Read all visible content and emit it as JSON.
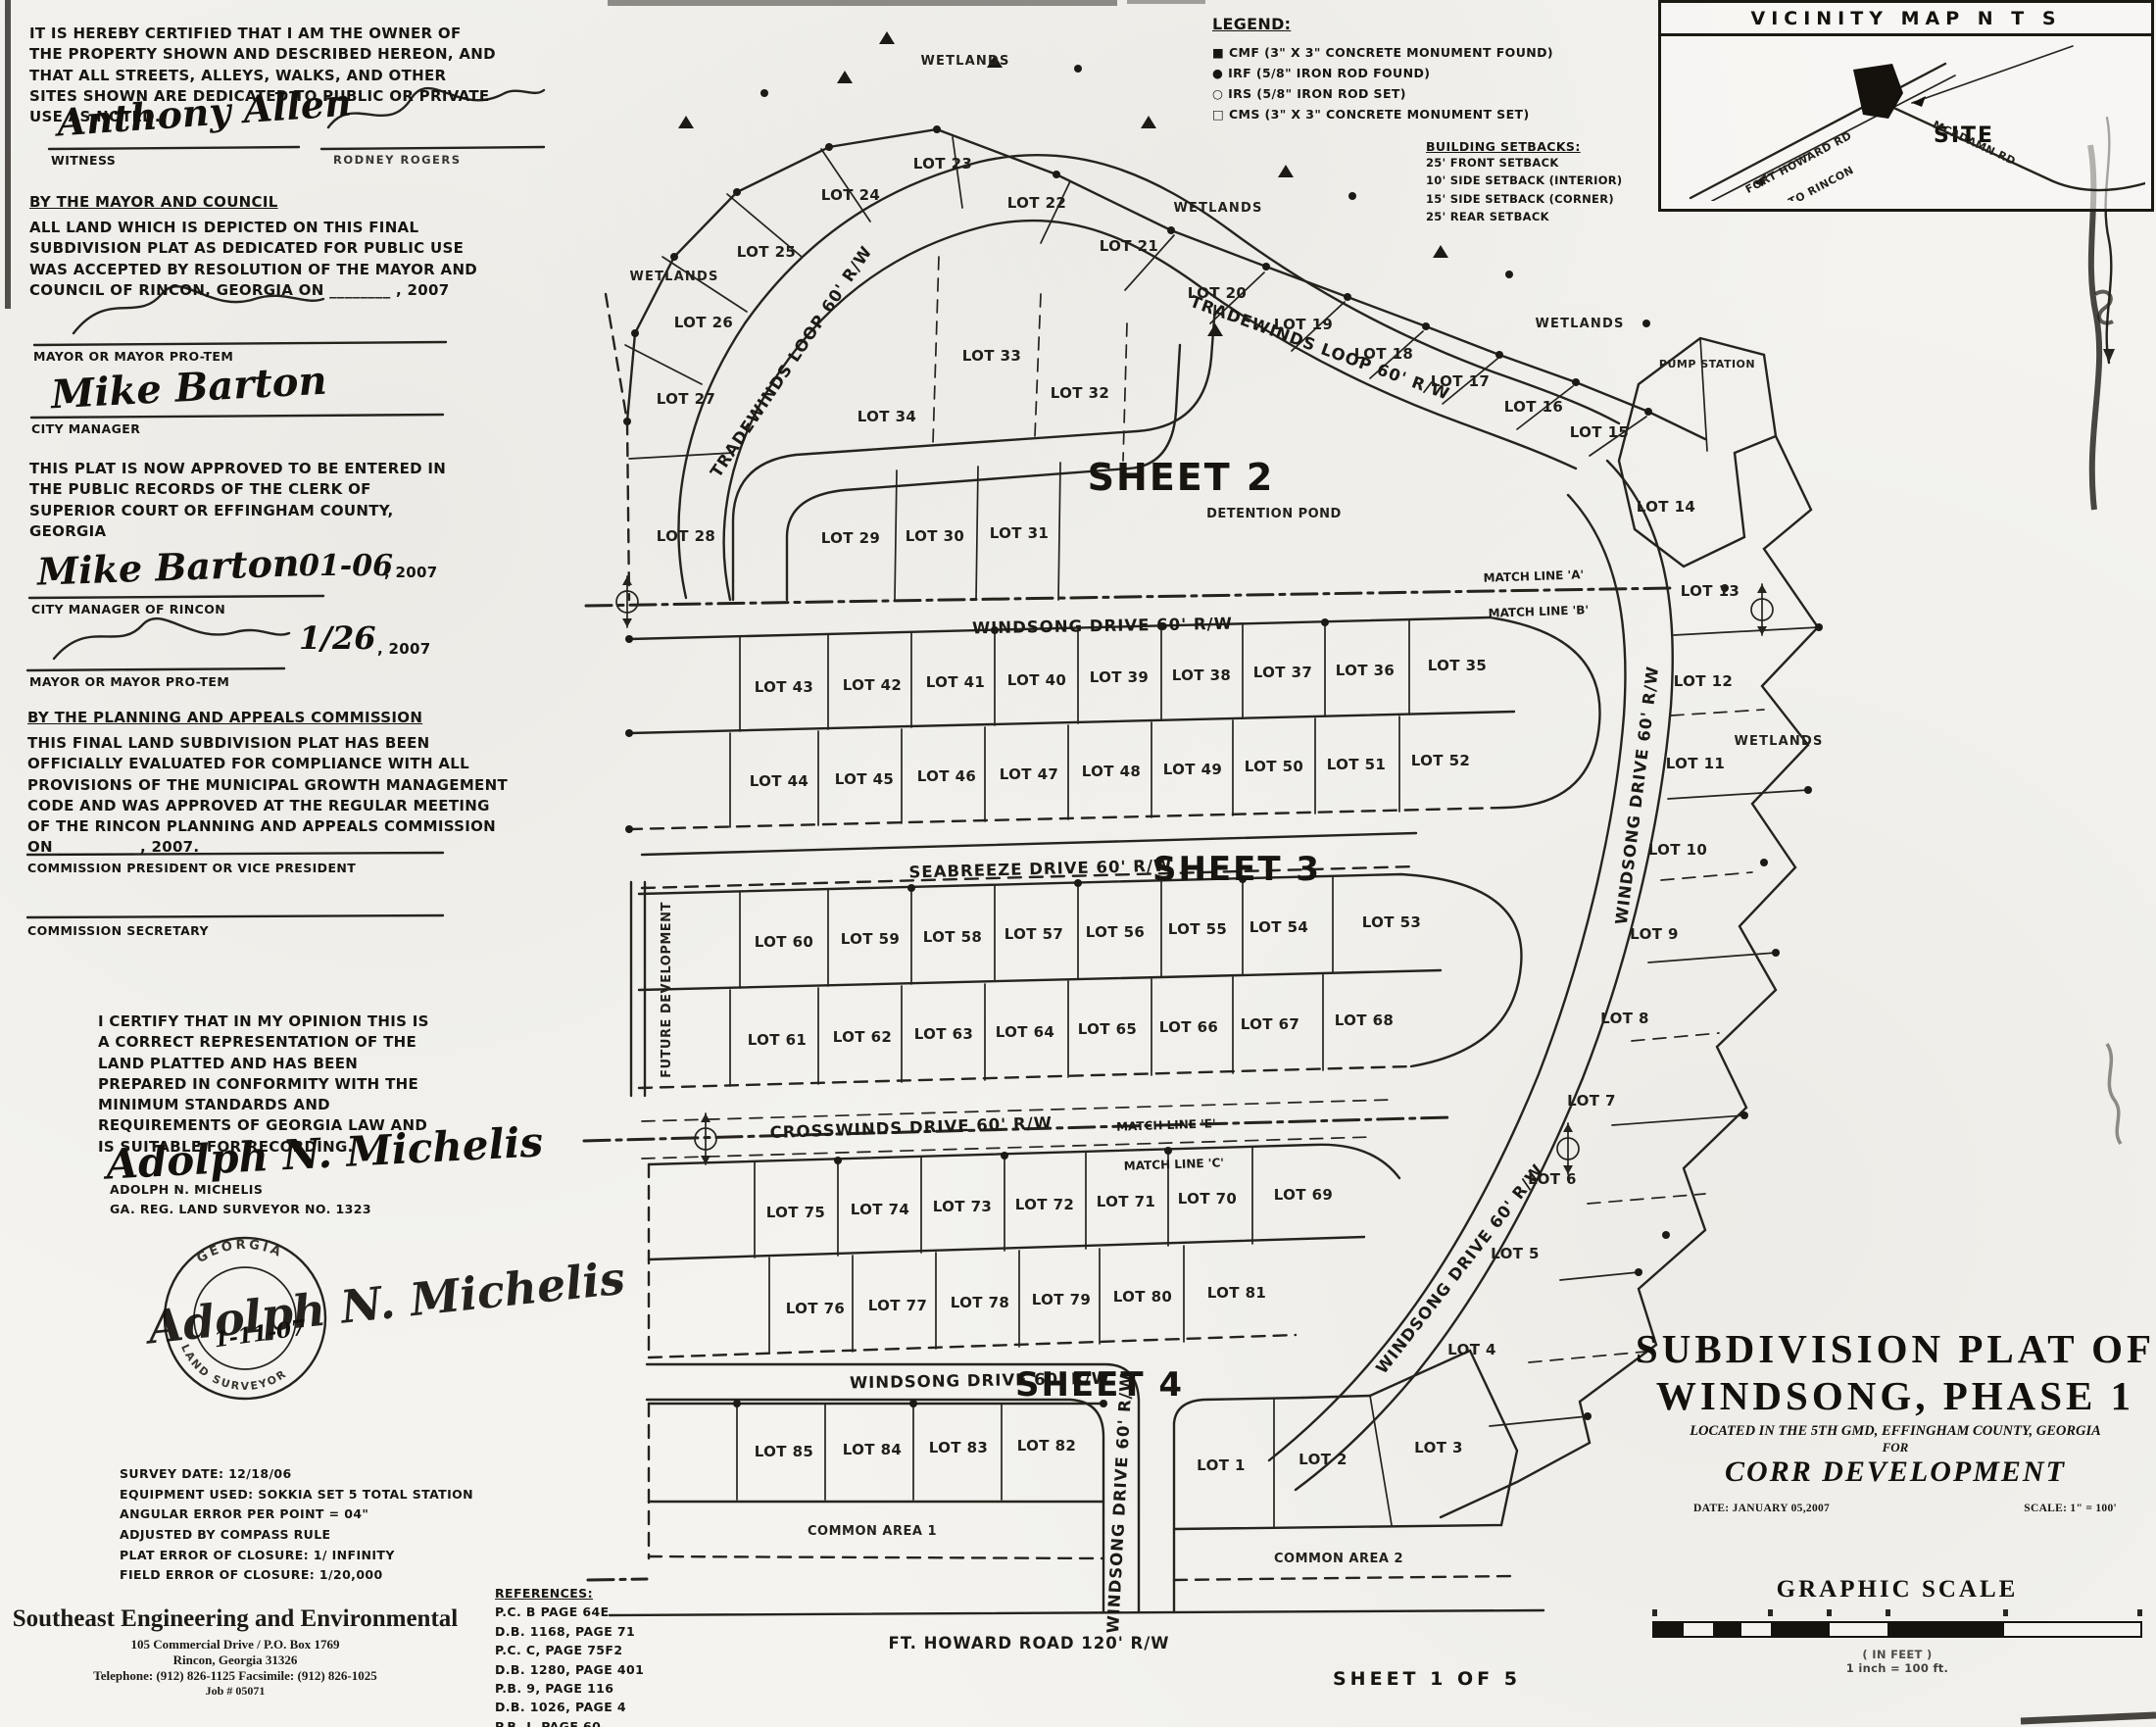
{
  "owner_cert": {
    "text": "IT IS HEREBY CERTIFIED THAT I AM THE OWNER OF THE PROPERTY SHOWN AND DESCRIBED HEREON, AND THAT ALL STREETS, ALLEYS, WALKS, AND OTHER SITES SHOWN ARE DEDICATED TO PUBLIC OR PRIVATE USE AS NOTED.",
    "witness_sig": "Anthony Allen",
    "witness_label": "WITNESS",
    "owner_sig_label": "RODNEY ROGERS"
  },
  "mayor_council": {
    "heading": "BY THE MAYOR AND COUNCIL",
    "text": "ALL LAND WHICH IS DEPICTED ON THIS FINAL SUBDIVISION PLAT AS DEDICATED FOR PUBLIC USE WAS ACCEPTED BY RESOLUTION OF THE MAYOR AND COUNCIL OF RINCON, GEORGIA ON  ________ , 2007",
    "mayor_label": "MAYOR OR MAYOR PRO-TEM",
    "manager_sig": "Mike Barton",
    "manager_label": "CITY MANAGER"
  },
  "clerk": {
    "text": "THIS PLAT IS NOW APPROVED TO BE ENTERED IN THE PUBLIC RECORDS OF THE CLERK OF SUPERIOR COURT OR EFFINGHAM COUNTY, GEORGIA",
    "sig": "Mike Barton",
    "date": "01-06",
    "year": ", 2007",
    "role": "CITY MANAGER OF RINCON",
    "date2": "1/26",
    "year2": ", 2007",
    "role2": "MAYOR OR MAYOR PRO-TEM"
  },
  "planning": {
    "heading": "BY THE PLANNING AND APPEALS COMMISSION",
    "text": "THIS FINAL LAND SUBDIVISION PLAT HAS BEEN OFFICIALLY EVALUATED FOR COMPLIANCE WITH ALL PROVISIONS OF THE MUNICIPAL GROWTH MANAGEMENT CODE AND WAS APPROVED AT THE REGULAR MEETING OF THE RINCON PLANNING AND APPEALS COMMISSION ON  __________ , 2007.",
    "pres": "COMMISSION PRESIDENT OR VICE PRESIDENT",
    "sec": "COMMISSION SECRETARY"
  },
  "surveyor": {
    "text": "I CERTIFY THAT IN MY OPINION THIS IS A CORRECT REPRESENTATION OF THE LAND PLATTED AND HAS BEEN PREPARED IN CONFORMITY WITH THE MINIMUM STANDARDS AND REQUIREMENTS OF GEORGIA LAW AND IS SUITABLE FOR RECORDING.",
    "sig": "Adolph N. Michelis",
    "name": "ADOLPH N. MICHELIS",
    "reg": "GA. REG. LAND SURVEYOR NO. 1323",
    "seal_top": "GEORGIA",
    "seal_bottom": "LAND SURVEYOR",
    "seal_date": "1-11-07"
  },
  "survey_info": {
    "lines": [
      "SURVEY DATE: 12/18/06",
      "EQUIPMENT USED: SOKKIA SET 5 TOTAL STATION",
      "ANGULAR ERROR PER POINT = 04\"",
      "ADJUSTED BY COMPASS RULE",
      "PLAT ERROR OF CLOSURE: 1/ INFINITY",
      "FIELD ERROR OF CLOSURE: 1/20,000"
    ]
  },
  "firm": {
    "name": "Southeast Engineering and Environmental",
    "addr1": "105 Commercial Drive / P.O. Box 1769",
    "addr2": "Rincon, Georgia 31326",
    "phone": "Telephone: (912) 826-1125      Facsimile: (912) 826-1025",
    "job": "Job # 05071"
  },
  "references": {
    "heading": "REFERENCES:",
    "items": [
      "P.C. B PAGE 64E",
      "D.B. 1168, PAGE 71",
      "P.C. C, PAGE 75F2",
      "D.B. 1280, PAGE 401",
      "P.B. 9, PAGE 116",
      "D.B. 1026, PAGE 4",
      "P.B. J, PAGE 60"
    ]
  },
  "legend": {
    "heading": "LEGEND:",
    "items": [
      {
        "sym": "■",
        "text": "CMF (3\" X 3\" CONCRETE MONUMENT FOUND)"
      },
      {
        "sym": "●",
        "text": "IRF (5/8\" IRON ROD FOUND)"
      },
      {
        "sym": "○",
        "text": "IRS (5/8\" IRON ROD SET)"
      },
      {
        "sym": "□",
        "text": "CMS (3\" X 3\" CONCRETE MONUMENT SET)"
      }
    ]
  },
  "setbacks": {
    "heading": "BUILDING SETBACKS:",
    "items": [
      "25' FRONT SETBACK",
      "10' SIDE SETBACK (INTERIOR)",
      "15' SIDE SETBACK (CORNER)",
      "25' REAR SETBACK"
    ]
  },
  "vicinity": {
    "title": "VICINITY MAP  N T S",
    "site": "SITE",
    "road1": "FORT HOWARD RD",
    "road2": "TO RINCON",
    "road3": "MCADAMN RD"
  },
  "title_block": {
    "line1": "SUBDIVISION PLAT OF",
    "line2": "WINDSONG, PHASE 1",
    "line3": "LOCATED IN THE 5TH GMD, EFFINGHAM COUNTY, GEORGIA",
    "line4": "FOR",
    "line5": "CORR DEVELOPMENT",
    "date": "DATE: JANUARY 05,2007",
    "scale": "SCALE: 1\" = 100'"
  },
  "graphic_scale": {
    "title": "GRAPHIC SCALE",
    "in_feet": "( IN FEET )",
    "ratio": "1 inch = 100 ft."
  },
  "sheet_footer": "SHEET 1 OF 5",
  "map": {
    "sheets": {
      "s2": "SHEET 2",
      "s3": "SHEET 3",
      "s4": "SHEET 4"
    },
    "features": {
      "detention": "DETENTION POND",
      "pump": "PUMP STATION",
      "future": "FUTURE DEVELOPMENT",
      "common1": "COMMON AREA 1",
      "common2": "COMMON AREA 2",
      "wetlands": "WETLANDS"
    },
    "streets": {
      "tradewinds": "TRADEWINDS LOOP 60' R/W",
      "windsong": "WINDSONG DRIVE 60' R/W",
      "seabreeze": "SEABREEZE DRIVE 60' R/W",
      "crosswinds": "CROSSWINDS DRIVE 60' R/W",
      "fthoward": "FT. HOWARD ROAD 120' R/W"
    },
    "match_lines": {
      "a": "MATCH LINE 'A'",
      "b": "MATCH LINE 'B'",
      "e": "MATCH LINE 'E'",
      "c": "MATCH LINE 'C'"
    },
    "lots": {
      "l1": "LOT 1",
      "l2": "LOT 2",
      "l3": "LOT 3",
      "l4": "LOT 4",
      "l5": "LOT 5",
      "l6": "LOT 6",
      "l7": "LOT 7",
      "l8": "LOT 8",
      "l9": "LOT 9",
      "l10": "LOT 10",
      "l11": "LOT 11",
      "l12": "LOT 12",
      "l13": "LOT 13",
      "l14": "LOT 14",
      "l15": "LOT 15",
      "l16": "LOT 16",
      "l17": "LOT 17",
      "l18": "LOT 18",
      "l19": "LOT 19",
      "l20": "LOT 20",
      "l21": "LOT 21",
      "l22": "LOT 22",
      "l23": "LOT 23",
      "l24": "LOT 24",
      "l25": "LOT 25",
      "l26": "LOT 26",
      "l27": "LOT 27",
      "l28": "LOT 28",
      "l29": "LOT 29",
      "l30": "LOT 30",
      "l31": "LOT 31",
      "l32": "LOT 32",
      "l33": "LOT 33",
      "l34": "LOT 34",
      "l35": "LOT 35",
      "l36": "LOT 36",
      "l37": "LOT 37",
      "l38": "LOT 38",
      "l39": "LOT 39",
      "l40": "LOT 40",
      "l41": "LOT 41",
      "l42": "LOT 42",
      "l43": "LOT 43",
      "l44": "LOT 44",
      "l45": "LOT 45",
      "l46": "LOT 46",
      "l47": "LOT 47",
      "l48": "LOT 48",
      "l49": "LOT 49",
      "l50": "LOT 50",
      "l51": "LOT 51",
      "l52": "LOT 52",
      "l53": "LOT 53",
      "l54": "LOT 54",
      "l55": "LOT 55",
      "l56": "LOT 56",
      "l57": "LOT 57",
      "l58": "LOT 58",
      "l59": "LOT 59",
      "l60": "LOT 60",
      "l61": "LOT 61",
      "l62": "LOT 62",
      "l63": "LOT 63",
      "l64": "LOT 64",
      "l65": "LOT 65",
      "l66": "LOT 66",
      "l67": "LOT 67",
      "l68": "LOT 68",
      "l69": "LOT 69",
      "l70": "LOT 70",
      "l71": "LOT 71",
      "l72": "LOT 72",
      "l73": "LOT 73",
      "l74": "LOT 74",
      "l75": "LOT 75",
      "l76": "LOT 76",
      "l77": "LOT 77",
      "l78": "LOT 78",
      "l79": "LOT 79",
      "l80": "LOT 80",
      "l81": "LOT 81",
      "l82": "LOT 82",
      "l83": "LOT 83",
      "l84": "LOT 84",
      "l85": "LOT 85"
    }
  }
}
